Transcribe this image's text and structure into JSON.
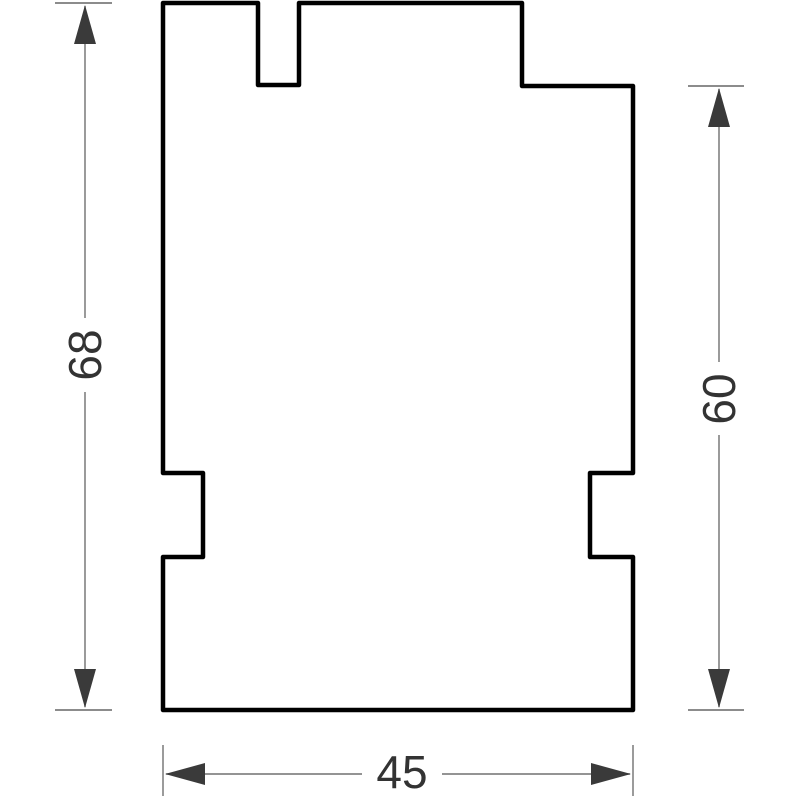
{
  "drawing": {
    "type": "technical-drawing",
    "background": "#ffffff",
    "outline_color": "#000000",
    "part_fill": "#ffffff",
    "dim_line_color": "#707070",
    "tick_color": "#8c8c8c",
    "arrow_color": "#3a3a3a",
    "text_color": "#333333",
    "dimensions": [
      {
        "id": "overall-height-left",
        "label": "68",
        "orientation": "vertical",
        "side": "left"
      },
      {
        "id": "step-height-right",
        "label": "60",
        "orientation": "vertical",
        "side": "right"
      },
      {
        "id": "overall-width-bottom",
        "label": "45",
        "orientation": "horizontal",
        "side": "bottom"
      }
    ]
  }
}
